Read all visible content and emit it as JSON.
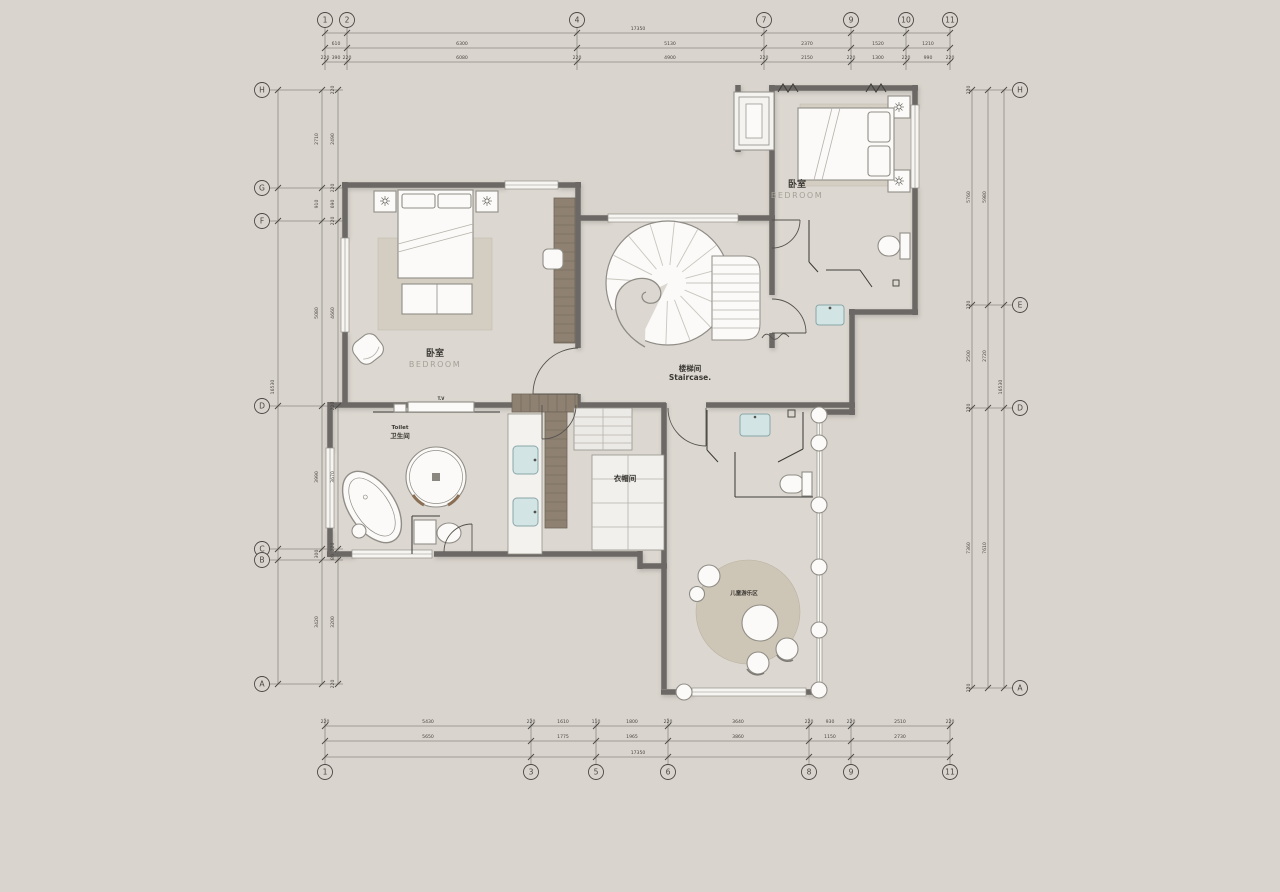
{
  "drawing": {
    "title": "second-floor-plan",
    "colors": {
      "background": "#d9d4cd",
      "floor": "#dcd8d1",
      "wall": "#6b6865",
      "window_white": "#f6f5f2",
      "closet_hatch": "#8e8172",
      "rug": "#d3cdc2",
      "kids_rug": "#cdc5b5",
      "sink_blue": "#d3e4e5",
      "dim_text": "#4b4744"
    },
    "rooms": {
      "bedroom_left": {
        "cn": "卧室",
        "en": "BEDROOM"
      },
      "bedroom_right": {
        "cn": "卧室",
        "en": "BEDROOM"
      },
      "staircase": {
        "cn": "楼梯间",
        "en": "Staircase."
      },
      "cloakroom": {
        "cn": "衣帽间"
      },
      "toilet": {
        "cn": "卫生间",
        "en": "Toilet"
      },
      "kids_area": {
        "cn": "儿童游乐区"
      },
      "tv": "T.V"
    },
    "axes": {
      "top": [
        {
          "label": "1",
          "x": 325
        },
        {
          "label": "2",
          "x": 347
        },
        {
          "label": "4",
          "x": 577
        },
        {
          "label": "7",
          "x": 764
        },
        {
          "label": "9",
          "x": 851
        },
        {
          "label": "10",
          "x": 906
        },
        {
          "label": "11",
          "x": 950
        }
      ],
      "bottom": [
        {
          "label": "1",
          "x": 325
        },
        {
          "label": "3",
          "x": 531
        },
        {
          "label": "5",
          "x": 596
        },
        {
          "label": "6",
          "x": 668
        },
        {
          "label": "8",
          "x": 809
        },
        {
          "label": "9",
          "x": 851
        },
        {
          "label": "11",
          "x": 950
        }
      ],
      "left": [
        {
          "label": "H",
          "y": 90
        },
        {
          "label": "G",
          "y": 188
        },
        {
          "label": "F",
          "y": 221
        },
        {
          "label": "D",
          "y": 406
        },
        {
          "label": "C",
          "y": 549
        },
        {
          "label": "B",
          "y": 560
        },
        {
          "label": "A",
          "y": 684
        }
      ],
      "right": [
        {
          "label": "H",
          "y": 90
        },
        {
          "label": "E",
          "y": 305
        },
        {
          "label": "D",
          "y": 408
        },
        {
          "label": "A",
          "y": 688
        }
      ]
    },
    "dim_texts": [
      {
        "t": "17350",
        "x": 638,
        "y": 30
      },
      {
        "t": "610",
        "x": 336,
        "y": 45
      },
      {
        "t": "6300",
        "x": 462,
        "y": 45
      },
      {
        "t": "5130",
        "x": 670,
        "y": 45
      },
      {
        "t": "2370",
        "x": 807,
        "y": 45
      },
      {
        "t": "1520",
        "x": 878,
        "y": 45
      },
      {
        "t": "1210",
        "x": 928,
        "y": 45
      },
      {
        "t": "220",
        "x": 325,
        "y": 59
      },
      {
        "t": "390",
        "x": 336,
        "y": 59
      },
      {
        "t": "220",
        "x": 347,
        "y": 59
      },
      {
        "t": "6080",
        "x": 462,
        "y": 59
      },
      {
        "t": "220",
        "x": 577,
        "y": 59
      },
      {
        "t": "4900",
        "x": 670,
        "y": 59
      },
      {
        "t": "220",
        "x": 764,
        "y": 59
      },
      {
        "t": "2150",
        "x": 807,
        "y": 59
      },
      {
        "t": "220",
        "x": 851,
        "y": 59
      },
      {
        "t": "1300",
        "x": 878,
        "y": 59
      },
      {
        "t": "220",
        "x": 906,
        "y": 59
      },
      {
        "t": "990",
        "x": 928,
        "y": 59
      },
      {
        "t": "220",
        "x": 950,
        "y": 59
      },
      {
        "t": "220",
        "x": 325,
        "y": 723
      },
      {
        "t": "5430",
        "x": 428,
        "y": 723
      },
      {
        "t": "220",
        "x": 531,
        "y": 723
      },
      {
        "t": "1610",
        "x": 563,
        "y": 723
      },
      {
        "t": "110",
        "x": 596,
        "y": 723
      },
      {
        "t": "1800",
        "x": 632,
        "y": 723
      },
      {
        "t": "220",
        "x": 668,
        "y": 723
      },
      {
        "t": "3640",
        "x": 738,
        "y": 723
      },
      {
        "t": "220",
        "x": 809,
        "y": 723
      },
      {
        "t": "930",
        "x": 830,
        "y": 723
      },
      {
        "t": "220",
        "x": 851,
        "y": 723
      },
      {
        "t": "2510",
        "x": 900,
        "y": 723
      },
      {
        "t": "220",
        "x": 950,
        "y": 723
      },
      {
        "t": "5650",
        "x": 428,
        "y": 738
      },
      {
        "t": "1775",
        "x": 563,
        "y": 738
      },
      {
        "t": "1965",
        "x": 632,
        "y": 738
      },
      {
        "t": "3860",
        "x": 738,
        "y": 738
      },
      {
        "t": "1150",
        "x": 830,
        "y": 738
      },
      {
        "t": "2730",
        "x": 900,
        "y": 738
      },
      {
        "t": "17350",
        "x": 638,
        "y": 754
      },
      {
        "t": "16530",
        "x": 274,
        "y": 387,
        "r": -90
      },
      {
        "t": "2710",
        "x": 318,
        "y": 139,
        "r": -90
      },
      {
        "t": "910",
        "x": 318,
        "y": 204,
        "r": -90
      },
      {
        "t": "5080",
        "x": 318,
        "y": 313,
        "r": -90
      },
      {
        "t": "3990",
        "x": 318,
        "y": 477,
        "r": -90
      },
      {
        "t": "300",
        "x": 318,
        "y": 554,
        "r": -90
      },
      {
        "t": "3420",
        "x": 318,
        "y": 622,
        "r": -90
      },
      {
        "t": "220",
        "x": 334,
        "y": 90,
        "r": -90
      },
      {
        "t": "2490",
        "x": 334,
        "y": 139,
        "r": -90
      },
      {
        "t": "220",
        "x": 334,
        "y": 188,
        "r": -90
      },
      {
        "t": "690",
        "x": 334,
        "y": 204,
        "r": -90
      },
      {
        "t": "220",
        "x": 334,
        "y": 221,
        "r": -90
      },
      {
        "t": "4660",
        "x": 334,
        "y": 313,
        "r": -90
      },
      {
        "t": "220",
        "x": 334,
        "y": 406,
        "r": -90
      },
      {
        "t": "3670",
        "x": 334,
        "y": 477,
        "r": -90
      },
      {
        "t": "220",
        "x": 334,
        "y": 547,
        "r": -90
      },
      {
        "t": "80",
        "x": 334,
        "y": 557,
        "r": -90
      },
      {
        "t": "3200",
        "x": 334,
        "y": 622,
        "r": -90
      },
      {
        "t": "220",
        "x": 334,
        "y": 684,
        "r": -90
      },
      {
        "t": "220",
        "x": 970,
        "y": 90,
        "r": -90
      },
      {
        "t": "5760",
        "x": 970,
        "y": 197,
        "r": -90
      },
      {
        "t": "220",
        "x": 970,
        "y": 305,
        "r": -90
      },
      {
        "t": "2500",
        "x": 970,
        "y": 356,
        "r": -90
      },
      {
        "t": "220",
        "x": 970,
        "y": 408,
        "r": -90
      },
      {
        "t": "7360",
        "x": 970,
        "y": 548,
        "r": -90
      },
      {
        "t": "220",
        "x": 970,
        "y": 688,
        "r": -90
      },
      {
        "t": "5980",
        "x": 986,
        "y": 197,
        "r": -90
      },
      {
        "t": "2720",
        "x": 986,
        "y": 356,
        "r": -90
      },
      {
        "t": "7610",
        "x": 986,
        "y": 548,
        "r": -90
      },
      {
        "t": "16530",
        "x": 1002,
        "y": 387,
        "r": -90
      }
    ]
  }
}
